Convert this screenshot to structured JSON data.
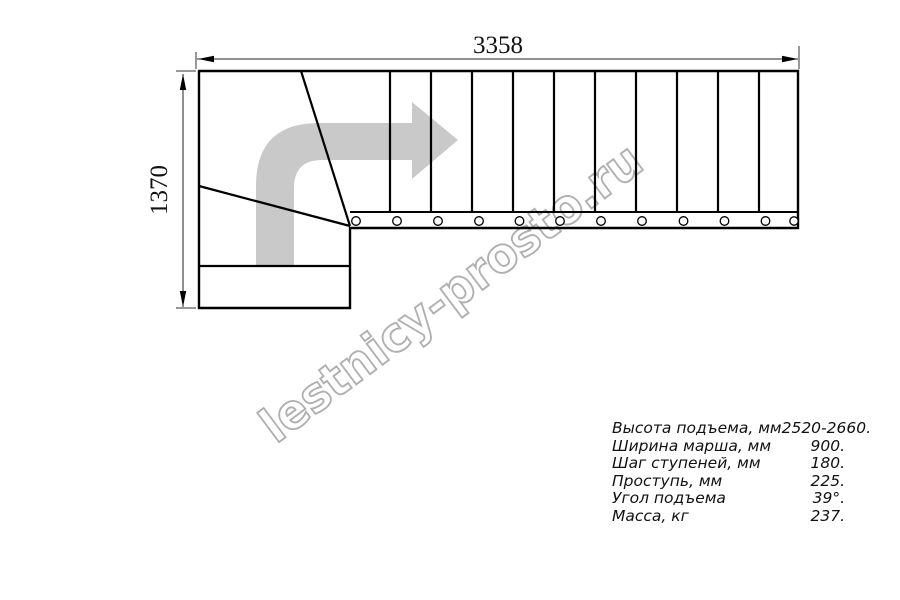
{
  "diagram": {
    "top_dimension": "3358",
    "left_dimension": "1370",
    "watermark": "lestnicy-prosto.ru"
  },
  "colors": {
    "line": "#000000",
    "arrow_gray": "#c9c9c9",
    "watermark_gray": "#b0b0b0",
    "background": "#ffffff"
  },
  "specs": {
    "rows": [
      {
        "label": "Высота подъема, мм",
        "value": "2520-2660."
      },
      {
        "label": "Ширина марша, мм",
        "value": "900."
      },
      {
        "label": "Шаг ступеней, мм",
        "value": "180."
      },
      {
        "label": "Проступь, мм",
        "value": "225."
      },
      {
        "label": "Угол подъема",
        "value": "39°."
      },
      {
        "label": "Масса, кг",
        "value": "237."
      }
    ]
  }
}
